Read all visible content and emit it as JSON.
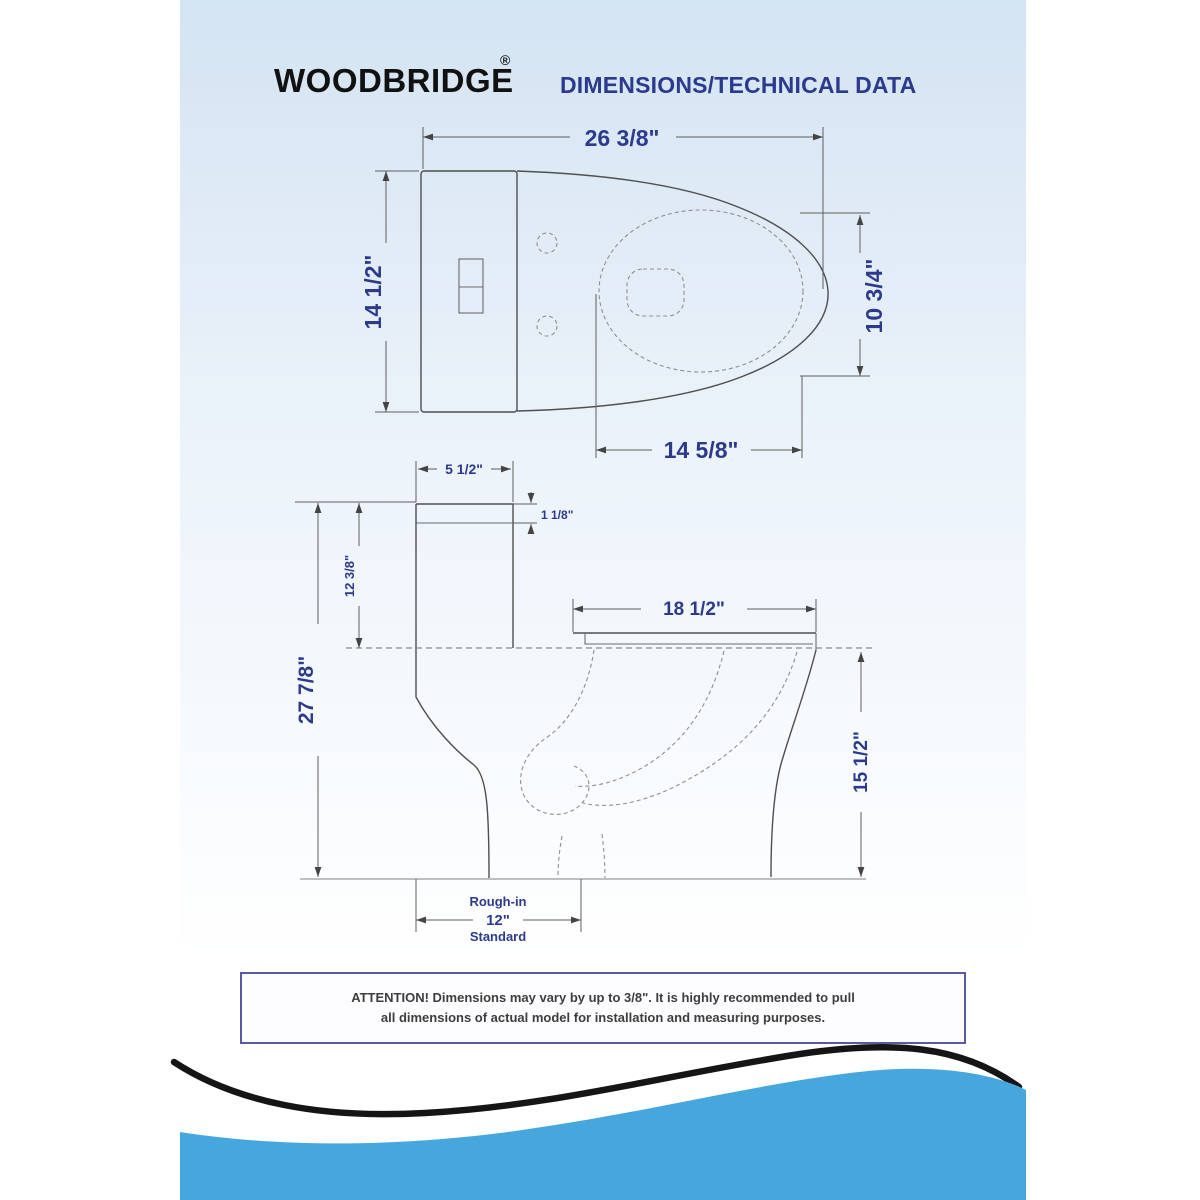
{
  "header": {
    "brand": "WOODBRIDGE",
    "registered": "®",
    "title": "DIMENSIONS/TECHNICAL DATA"
  },
  "top_view": {
    "overall_depth": "26 3/8\"",
    "tank_width": "14 1/2\"",
    "bowl_opening_width": "10 3/4\"",
    "bowl_opening_length": "14 5/8\""
  },
  "side_view": {
    "tank_top_depth": "5 1/2\"",
    "lid_thickness": "1 1/8\"",
    "tank_height": "12 3/8\"",
    "overall_height": "27 7/8\"",
    "seat_depth": "18 1/2\"",
    "rim_height": "15 1/2\"",
    "rough_in_label": "Rough-in",
    "rough_in_value": "12\"",
    "rough_in_standard": "Standard"
  },
  "attention": {
    "line1": "ATTENTION! Dimensions may vary by up to 3/8\". It is highly recommended to pull",
    "line2": "all dimensions of actual model for installation and measuring purposes."
  },
  "colors": {
    "accent_blue": "#45a7de",
    "label_navy": "#2b3a8c",
    "swoosh_black": "#151515"
  }
}
